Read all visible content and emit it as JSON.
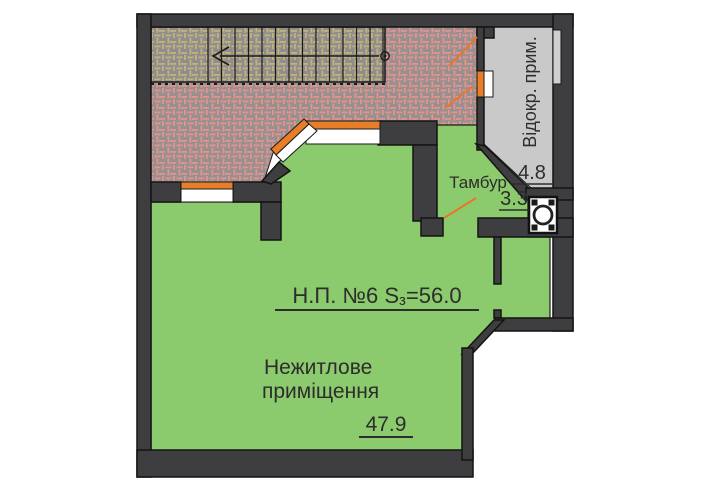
{
  "plan": {
    "unit_title": {
      "prefix": "Н.П. №6 S",
      "subscript": "з",
      "suffix": "=56.0"
    },
    "main_room": {
      "name_line1": "Нежитлове",
      "name_line2": "приміщення",
      "area": "47.9"
    },
    "vestibule": {
      "name": "Тамбур",
      "area": "3.3"
    },
    "separate_room": {
      "name": "Відокр. прим.",
      "area": "4.8"
    },
    "colors": {
      "room_green": "#8CCA6E",
      "hatch_base_gray": "#8F8F8F",
      "landing_pink_hatch": "#E6938B",
      "stairs_tan_hatch": "#C6B279",
      "separate_room_gray": "#C9C9C9",
      "wall_dark": "#3E3E40",
      "window_orange": "#E87E28",
      "leader_orange": "#E8772B"
    }
  }
}
